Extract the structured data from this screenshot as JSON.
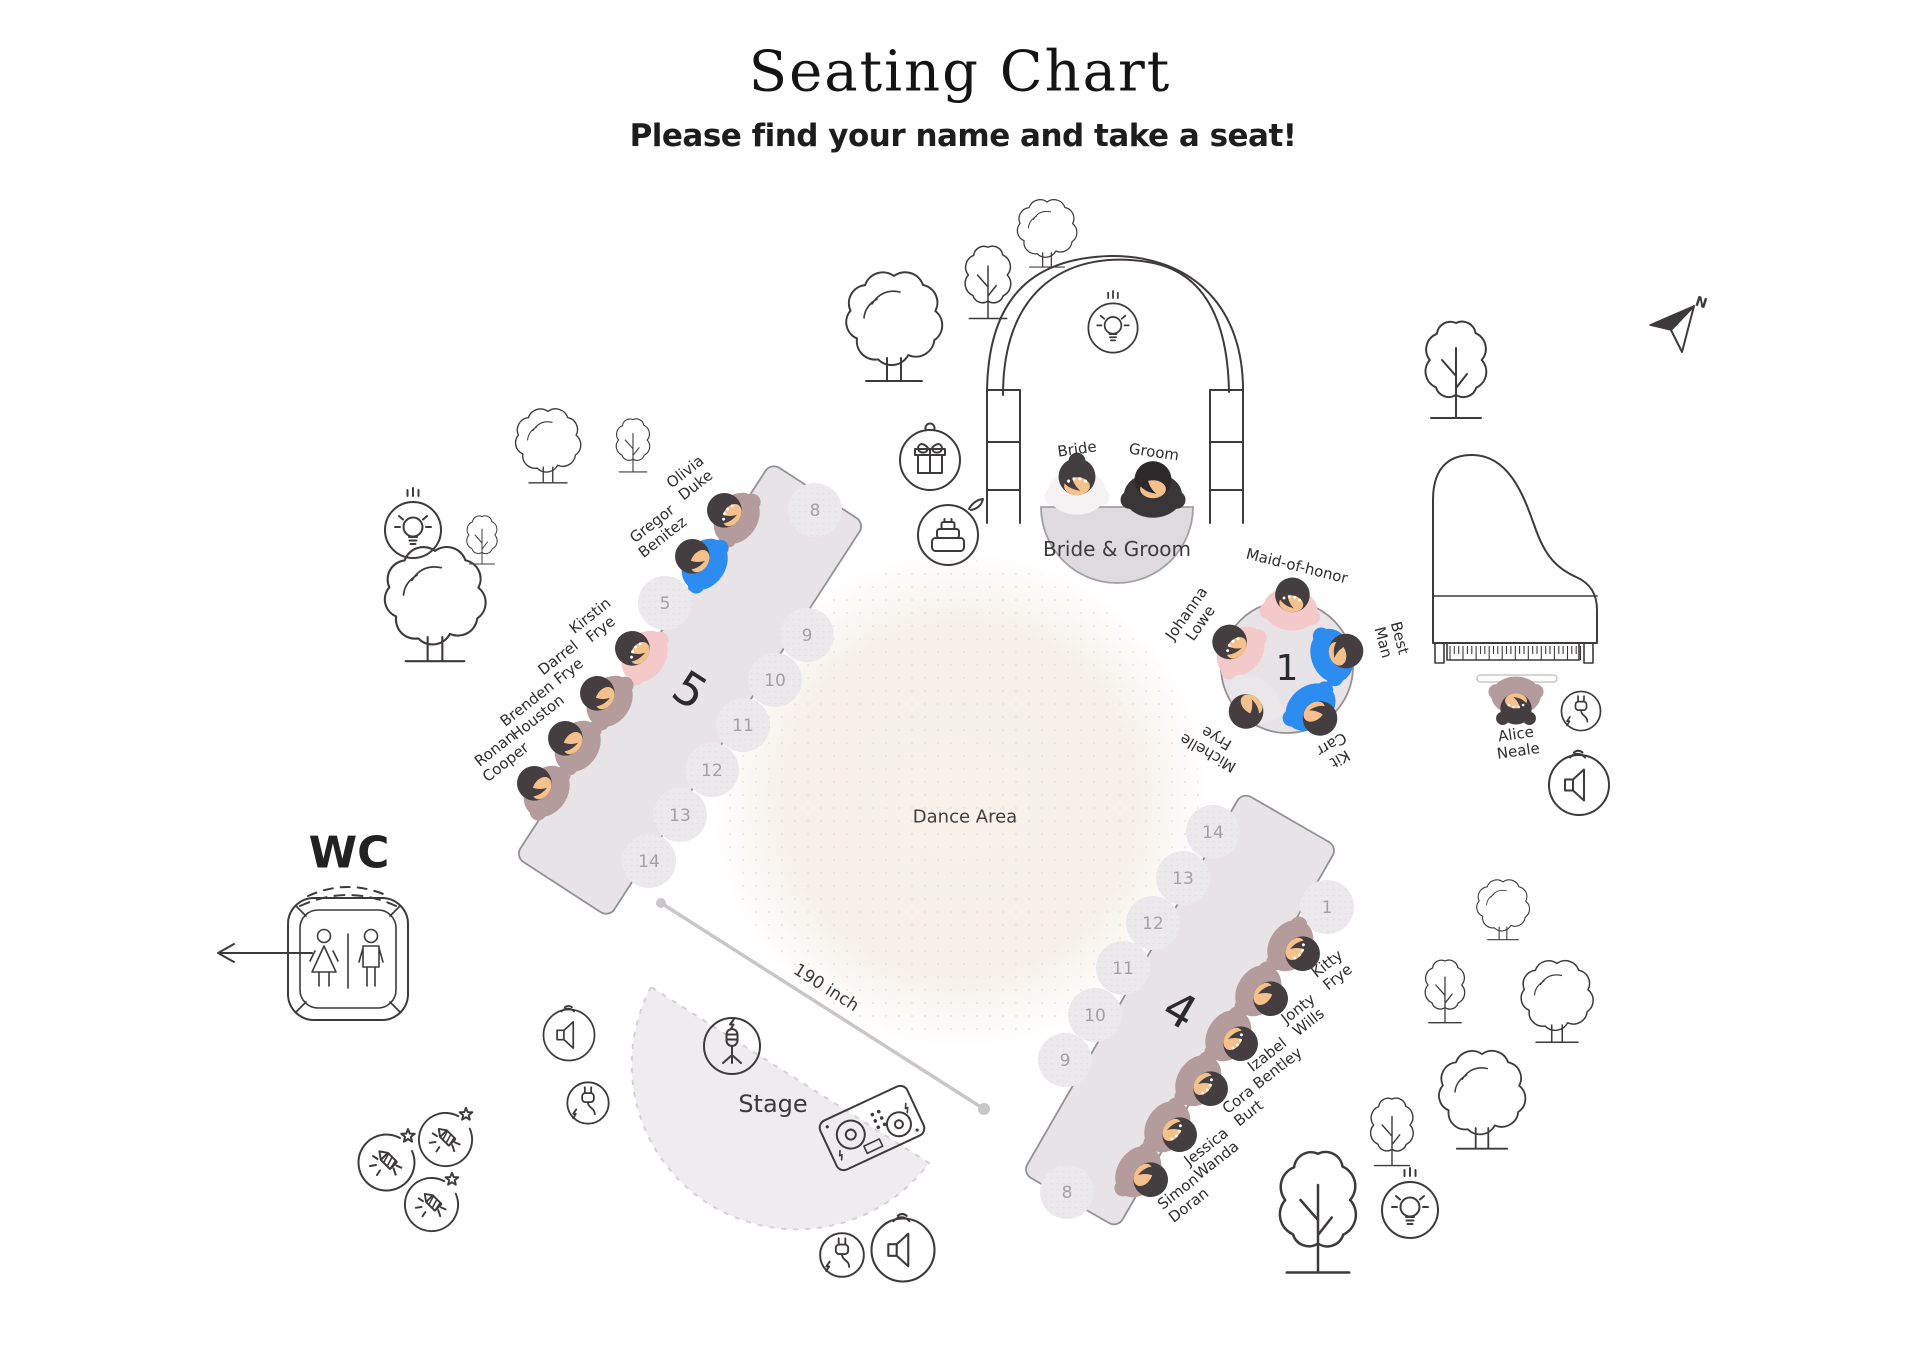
{
  "header": {
    "title": "Seating Chart",
    "subtitle": "Please find your name and take a seat!"
  },
  "labels": {
    "dance_area": "Dance Area",
    "stage": "Stage",
    "wc": "WC",
    "measurement": "190 inch",
    "north": "N"
  },
  "head_table": {
    "label": "Bride & Groom",
    "x": 1117,
    "y": 507,
    "r": 76
  },
  "tables": [
    {
      "id": "1",
      "shape": "round",
      "x": 1287,
      "y": 667,
      "r": 66,
      "rot": 0,
      "label_size": 36
    },
    {
      "id": "5",
      "shape": "rect",
      "x": 690,
      "y": 690,
      "w": 112,
      "h": 470,
      "rot": 33,
      "label_size": 46
    },
    {
      "id": "4",
      "shape": "rect",
      "x": 1180,
      "y": 1010,
      "w": 110,
      "h": 440,
      "rot": 30,
      "label_size": 46
    }
  ],
  "guests": [
    {
      "name": "Bride",
      "lines": [
        "Bride"
      ],
      "table": "head",
      "x": 1077,
      "y": 480,
      "rot": 0,
      "outfit": "bride",
      "variant": "bride",
      "dots": true,
      "label": {
        "x": 1077,
        "y": 449,
        "rot": -8
      }
    },
    {
      "name": "Groom",
      "lines": [
        "Groom"
      ],
      "table": "head",
      "x": 1153,
      "y": 483,
      "rot": 0,
      "outfit": "groom",
      "variant": "groom",
      "dots": false,
      "label": {
        "x": 1154,
        "y": 452,
        "rot": 8
      }
    },
    {
      "name": "Maid-of-honor",
      "lines": [
        "Maid-of-honor"
      ],
      "table": "1",
      "x": 1292,
      "y": 598,
      "rot": 8,
      "outfit": "pink",
      "dots": true,
      "label": {
        "x": 1297,
        "y": 566,
        "rot": 14
      }
    },
    {
      "name": "Johanna Lowe",
      "lines": [
        "Johanna",
        "Lowe"
      ],
      "table": "1",
      "x": 1232,
      "y": 644,
      "rot": -49,
      "outfit": "pink",
      "dots": true,
      "label": {
        "x": 1193,
        "y": 618,
        "rot": -55
      }
    },
    {
      "name": "Best Man",
      "lines": [
        "Best",
        "Man"
      ],
      "table": "1",
      "x": 1343,
      "y": 652,
      "rot": 72,
      "outfit": "blue",
      "dots": false,
      "label": {
        "x": 1392,
        "y": 640,
        "rot": 75
      }
    },
    {
      "name": "Kit Carr",
      "lines": [
        "Kit",
        "Carr"
      ],
      "table": "1",
      "x": 1318,
      "y": 716,
      "rot": 140,
      "outfit": "blue",
      "dots": false,
      "label": {
        "x": 1336,
        "y": 752,
        "rot": 150
      }
    },
    {
      "name": "Michelle Frye",
      "lines": [
        "Michelle",
        "Frye"
      ],
      "table": "1",
      "x": 1248,
      "y": 709,
      "rot": -142,
      "outfit": "white",
      "dots": false,
      "label": {
        "x": 1212,
        "y": 746,
        "rot": -150
      }
    },
    {
      "name": "Olivia Duke",
      "lines": [
        "Olivia",
        "Duke"
      ],
      "table": "5",
      "x": 727,
      "y": 512,
      "rot": -57,
      "outfit": "mauve",
      "dots": true,
      "label": {
        "x": 690,
        "y": 478,
        "rot": -38
      }
    },
    {
      "name": "Gregor Benitez",
      "lines": [
        "Gregor",
        "Benitez"
      ],
      "table": "5",
      "x": 695,
      "y": 558,
      "rot": -57,
      "outfit": "blue",
      "dots": false,
      "label": {
        "x": 657,
        "y": 530,
        "rot": -38
      }
    },
    {
      "name": "Kirstin Frye",
      "lines": [
        "Kirstin",
        "Frye"
      ],
      "table": "5",
      "x": 635,
      "y": 650,
      "rot": -57,
      "outfit": "pink",
      "dots": true,
      "label": {
        "x": 595,
        "y": 622,
        "rot": -38
      }
    },
    {
      "name": "Darrel Frye",
      "lines": [
        "Darrel",
        "Frye"
      ],
      "table": "5",
      "x": 600,
      "y": 695,
      "rot": -57,
      "outfit": "mauve",
      "dots": false,
      "label": {
        "x": 563,
        "y": 664,
        "rot": -38
      }
    },
    {
      "name": "Brenden Houston",
      "lines": [
        "Brenden",
        "Houston"
      ],
      "table": "5",
      "x": 568,
      "y": 740,
      "rot": -57,
      "outfit": "mauve",
      "dots": false,
      "label": {
        "x": 532,
        "y": 710,
        "rot": -38
      }
    },
    {
      "name": "Ronan Cooper",
      "lines": [
        "Ronan",
        "Cooper"
      ],
      "table": "5",
      "x": 537,
      "y": 785,
      "rot": -57,
      "outfit": "mauve",
      "dots": false,
      "label": {
        "x": 500,
        "y": 755,
        "rot": -38
      }
    },
    {
      "name": "Kitty Frye",
      "lines": [
        "Kitty",
        "Frye"
      ],
      "table": "4",
      "x": 1300,
      "y": 952,
      "rot": 123,
      "outfit": "mauve",
      "dots": true,
      "label": {
        "x": 1332,
        "y": 970,
        "rot": -38
      }
    },
    {
      "name": "Jonty Wills",
      "lines": [
        "Jonty",
        "Wills"
      ],
      "table": "4",
      "x": 1268,
      "y": 997,
      "rot": 123,
      "outfit": "mauve",
      "dots": false,
      "label": {
        "x": 1303,
        "y": 1015,
        "rot": -38
      }
    },
    {
      "name": "Izabel Bentley",
      "lines": [
        "Izabel",
        "Bentley"
      ],
      "table": "4",
      "x": 1238,
      "y": 1042,
      "rot": 123,
      "outfit": "mauve",
      "dots": true,
      "label": {
        "x": 1272,
        "y": 1061,
        "rot": -38
      }
    },
    {
      "name": "Cora Burt",
      "lines": [
        "Cora",
        "Burt"
      ],
      "table": "4",
      "x": 1208,
      "y": 1087,
      "rot": 123,
      "outfit": "mauve",
      "dots": true,
      "label": {
        "x": 1243,
        "y": 1106,
        "rot": -38
      }
    },
    {
      "name": "Jessica Wanda",
      "lines": [
        "Jessica",
        "Wanda"
      ],
      "table": "4",
      "x": 1177,
      "y": 1133,
      "rot": 123,
      "outfit": "mauve",
      "dots": true,
      "label": {
        "x": 1211,
        "y": 1153,
        "rot": -38
      }
    },
    {
      "name": "Simon Doran",
      "lines": [
        "Simon",
        "Doran"
      ],
      "table": "4",
      "x": 1148,
      "y": 1178,
      "rot": 123,
      "outfit": "mauve",
      "dots": false,
      "label": {
        "x": 1183,
        "y": 1198,
        "rot": -38
      }
    },
    {
      "name": "Alice Neale",
      "lines": [
        "Alice",
        "Neale"
      ],
      "table": "piano",
      "x": 1516,
      "y": 706,
      "rot": 180,
      "outfit": "mauve",
      "variant": "pigtails",
      "dots": true,
      "label": {
        "x": 1517,
        "y": 742,
        "rot": -8
      }
    }
  ],
  "empty_seats": [
    {
      "n": "5",
      "x": 665,
      "y": 603
    },
    {
      "n": "8",
      "x": 815,
      "y": 510
    },
    {
      "n": "9",
      "x": 807,
      "y": 635
    },
    {
      "n": "10",
      "x": 775,
      "y": 680
    },
    {
      "n": "11",
      "x": 743,
      "y": 725
    },
    {
      "n": "12",
      "x": 712,
      "y": 770
    },
    {
      "n": "13",
      "x": 680,
      "y": 815
    },
    {
      "n": "14",
      "x": 649,
      "y": 861
    },
    {
      "n": "1",
      "x": 1327,
      "y": 907
    },
    {
      "n": "14",
      "x": 1213,
      "y": 832
    },
    {
      "n": "13",
      "x": 1183,
      "y": 878
    },
    {
      "n": "12",
      "x": 1153,
      "y": 923
    },
    {
      "n": "11",
      "x": 1123,
      "y": 968
    },
    {
      "n": "10",
      "x": 1095,
      "y": 1015
    },
    {
      "n": "9",
      "x": 1065,
      "y": 1060
    },
    {
      "n": "8",
      "x": 1067,
      "y": 1192
    }
  ],
  "trees": [
    {
      "style": "cloud",
      "x": 894,
      "y": 318,
      "s": 1.0
    },
    {
      "style": "cloud",
      "x": 1047,
      "y": 228,
      "s": 0.62
    },
    {
      "style": "cloud",
      "x": 548,
      "y": 440,
      "s": 0.68
    },
    {
      "style": "cloud",
      "x": 435,
      "y": 595,
      "s": 1.05
    },
    {
      "style": "cloud",
      "x": 1482,
      "y": 1092,
      "s": 0.9
    },
    {
      "style": "cloud",
      "x": 1503,
      "y": 905,
      "s": 0.55
    },
    {
      "style": "cloud",
      "x": 1557,
      "y": 995,
      "s": 0.75
    },
    {
      "style": "pointy",
      "x": 988,
      "y": 275,
      "s": 0.75
    },
    {
      "style": "pointy",
      "x": 633,
      "y": 440,
      "s": 0.55
    },
    {
      "style": "pointy",
      "x": 482,
      "y": 535,
      "s": 0.5
    },
    {
      "style": "pointy",
      "x": 1392,
      "y": 1125,
      "s": 0.7
    },
    {
      "style": "pointy",
      "x": 1318,
      "y": 1200,
      "s": 1.25
    },
    {
      "style": "pointy",
      "x": 1445,
      "y": 985,
      "s": 0.65
    },
    {
      "style": "pointy",
      "x": 1456,
      "y": 360,
      "s": 1.0
    }
  ],
  "icons": [
    {
      "type": "bulb",
      "x": 1113,
      "y": 328,
      "s": 0.88
    },
    {
      "type": "bulb",
      "x": 413,
      "y": 530,
      "s": 1.0
    },
    {
      "type": "bulb",
      "x": 1410,
      "y": 1210,
      "s": 1.0
    },
    {
      "type": "gift",
      "x": 930,
      "y": 460,
      "s": 1.0
    },
    {
      "type": "cake",
      "x": 948,
      "y": 535,
      "s": 1.0
    },
    {
      "type": "mic",
      "x": 732,
      "y": 1046,
      "s": 1.0
    },
    {
      "type": "plug",
      "x": 588,
      "y": 1103,
      "s": 0.9
    },
    {
      "type": "plug",
      "x": 842,
      "y": 1255,
      "s": 0.95
    },
    {
      "type": "plug",
      "x": 1581,
      "y": 711,
      "s": 0.85
    },
    {
      "type": "speaker",
      "x": 569,
      "y": 1035,
      "s": 0.85
    },
    {
      "type": "speaker",
      "x": 903,
      "y": 1250,
      "s": 1.05
    },
    {
      "type": "speaker",
      "x": 1579,
      "y": 785,
      "s": 1.0
    },
    {
      "type": "firework",
      "x": 387,
      "y": 1163,
      "s": 1.0
    },
    {
      "type": "firework",
      "x": 446,
      "y": 1140,
      "s": 0.95
    },
    {
      "type": "firework",
      "x": 432,
      "y": 1205,
      "s": 0.95
    },
    {
      "type": "dj",
      "x": 872,
      "y": 1128,
      "s": 1.0,
      "rot": -25
    }
  ],
  "colors": {
    "line": "#3e3a3b",
    "table_fill": "#e7e3e7",
    "table_stroke": "#949094",
    "head_table_fill": "#dedade",
    "seat_fill": "#ebe9eb",
    "seat_text": "#a3a0a3",
    "table_label": "#2b2b2b",
    "guest_label": "#2d2d2d",
    "dance_fill": "#f6efe7",
    "stage_fill": "#efecf0",
    "measure": "#c9c5c9",
    "skin": "#f4c08c",
    "hair": "#453e40",
    "groom_hair": "#2d282a",
    "outfits": {
      "mauve": "#b59c9c",
      "blue": "#2d8cf0",
      "pink": "#f4c9c9",
      "white": "#e9e7ea",
      "bride": "#f4f2f3",
      "groom": "#3a3537"
    }
  }
}
